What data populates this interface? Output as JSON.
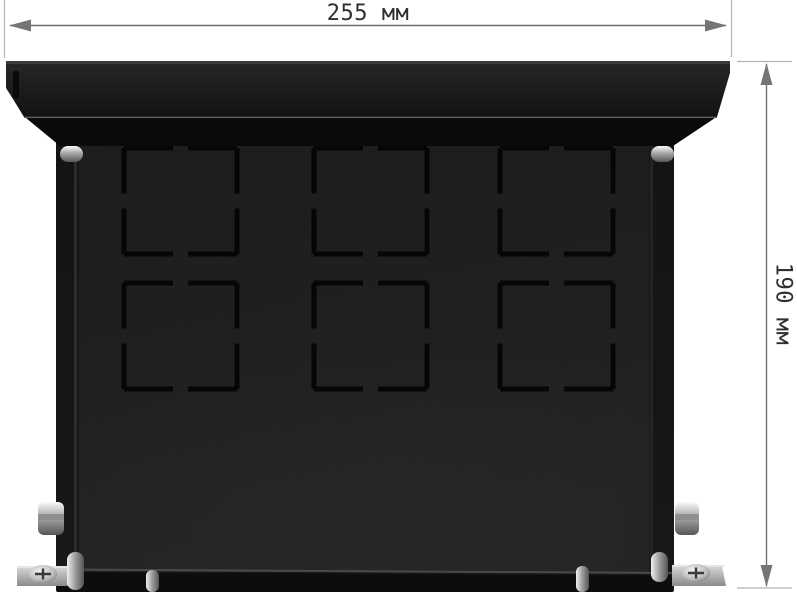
{
  "canvas": {
    "width": 797,
    "height": 600,
    "background": "#ffffff"
  },
  "description": "Black sheet-metal floor-box enclosure shown from the front with six square knockout cutouts, chrome screws, cable glands and mounting feet, annotated with overall width and height dimensions.",
  "dimension_annotations": {
    "width_label": "255 мм",
    "height_label": "190 мм",
    "line_color": "#6e6e6e",
    "extension_line_color": "#b2b2b2",
    "arrow_color": "#757575",
    "label_color": "#2f2f2f"
  },
  "enclosure": {
    "lid_color": "#1d1d1d",
    "body_color": "#161616",
    "panel_color": "#1e1e1e",
    "slot_color": "#060606",
    "chrome_color": "#c9c9c9",
    "foot_color": "#b5b5b5",
    "knockout_grid": {
      "rows": 2,
      "columns": 3,
      "total": 6,
      "x_positions": [
        124,
        314,
        500
      ],
      "y_positions": [
        148,
        283
      ],
      "width": 113,
      "height": 106,
      "side_gap": 15,
      "slot_thickness": 5,
      "slot_color": "#060606"
    }
  }
}
